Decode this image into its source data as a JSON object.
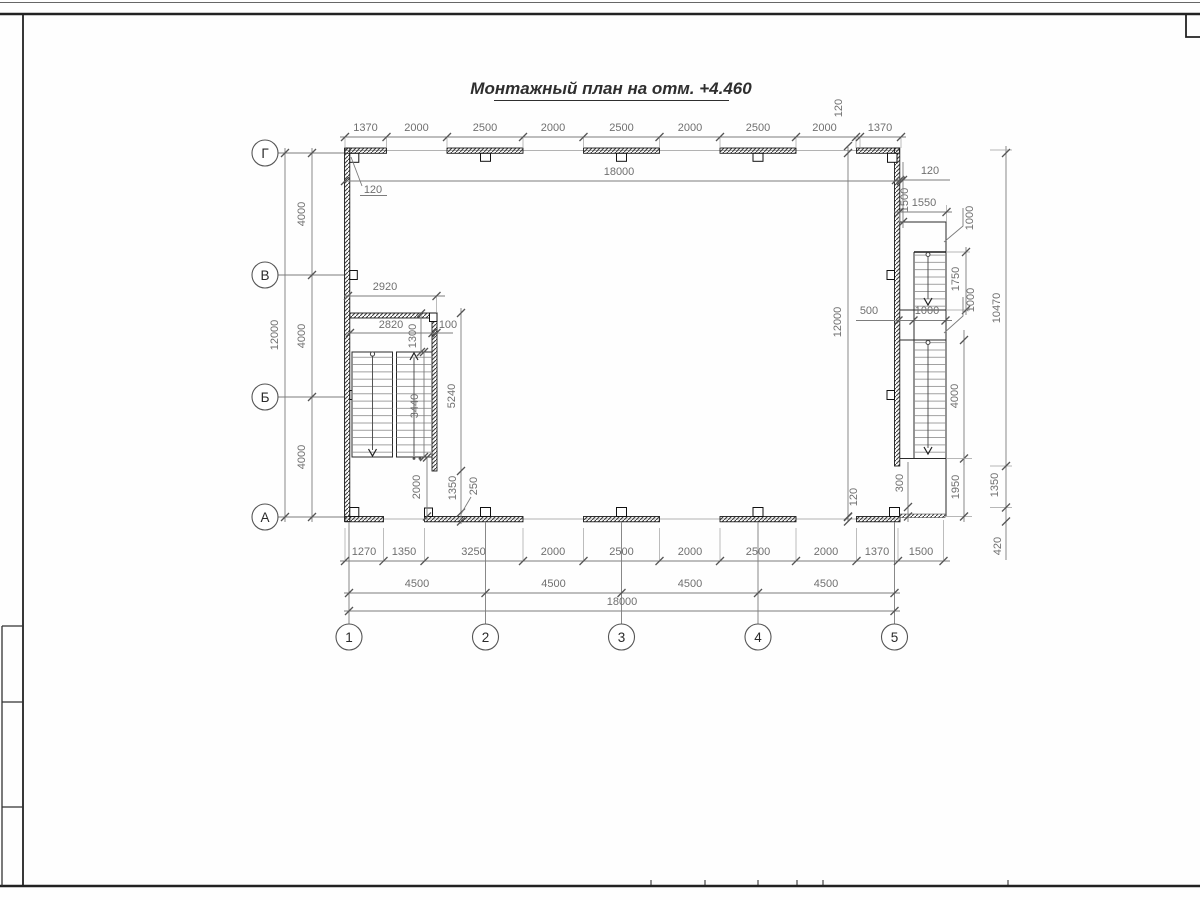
{
  "sheet": {
    "title": "Монтажный план на отм. +4.460"
  },
  "axes": {
    "rows": [
      "Г",
      "В",
      "Б",
      "А"
    ],
    "cols": [
      "1",
      "2",
      "3",
      "4",
      "5"
    ]
  },
  "dims": {
    "top_row": [
      "1370",
      "2000",
      "2500",
      "2000",
      "2500",
      "2000",
      "2500",
      "2000",
      "1370"
    ],
    "top_120": "120",
    "top_total": "18000",
    "corner_120": "120",
    "left_row": [
      "4000",
      "4000",
      "4000"
    ],
    "left_total": "12000",
    "bottom_row1": [
      "1270",
      "1350",
      "3250",
      "2000",
      "2500",
      "2000",
      "2500",
      "2000",
      "1370",
      "1500"
    ],
    "bottom_row2": [
      "4500",
      "4500",
      "4500",
      "4500"
    ],
    "bottom_total": "18000",
    "stair_left": {
      "w2920": "2920",
      "w2820": "2820",
      "w100": "100",
      "h1300": "1300",
      "h3440": "3440",
      "h5240": "5240",
      "h2000": "2000",
      "h1350": "1350",
      "h250": "250"
    },
    "stair_right": {
      "t120": "120",
      "h1500": "1500",
      "w1550": "1550",
      "lead1000_top": "1000",
      "h1750": "1750",
      "lead1000_mid": "1000",
      "w500": "500",
      "w1000": "1000",
      "h12000": "12000",
      "h10470": "10470",
      "h4000": "4000",
      "h300": "300",
      "h1950": "1950",
      "h1350": "1350",
      "h420": "420",
      "b120": "120"
    }
  }
}
